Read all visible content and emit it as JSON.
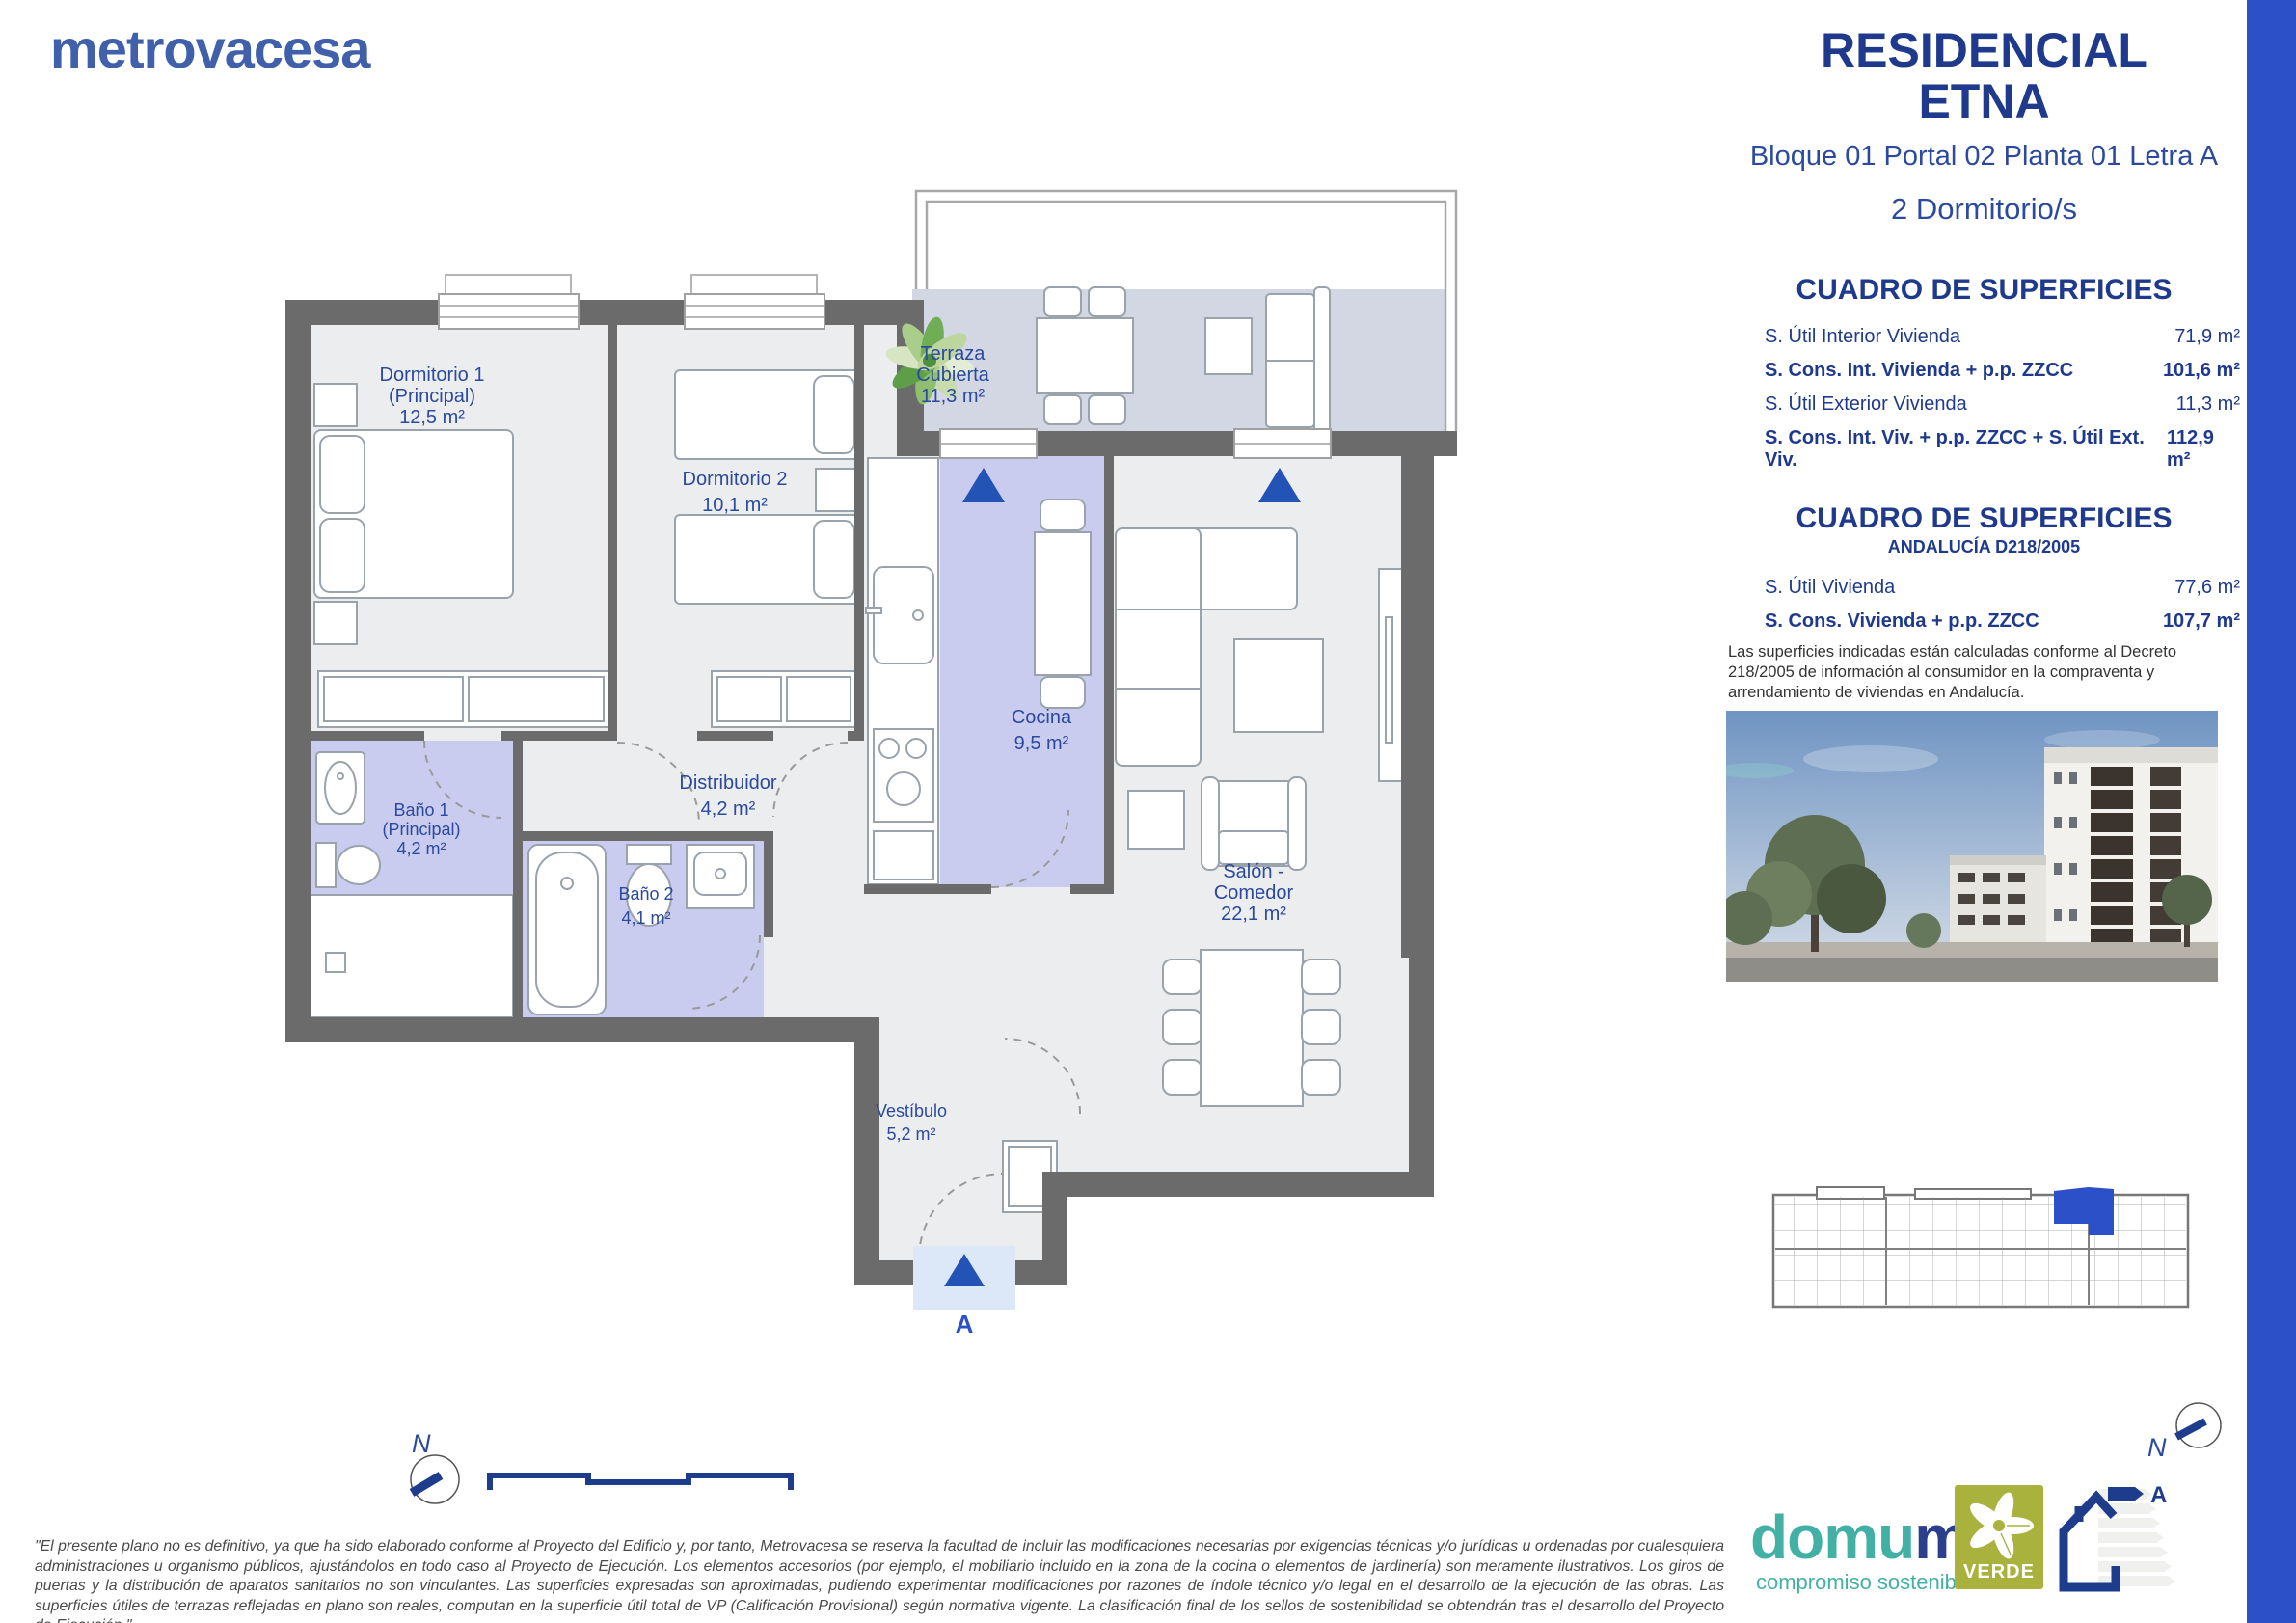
{
  "brand": {
    "logo_text": "metrovacesa"
  },
  "header": {
    "title_line1": "RESIDENCIAL",
    "title_line2": "ETNA",
    "location": "Bloque 01 Portal 02 Planta 01 Letra A",
    "bedrooms": "2 Dormitorio/s"
  },
  "surfaces": {
    "title": "CUADRO DE SUPERFICIES",
    "rows": [
      {
        "label": "S. Útil Interior Vivienda",
        "value": "71,9 m²"
      },
      {
        "label": "S. Cons. Int. Vivienda + p.p. ZZCC",
        "value": "101,6 m²"
      },
      {
        "label": "S. Útil Exterior Vivienda",
        "value": "11,3 m²"
      },
      {
        "label": "S. Cons. Int. Viv. + p.p. ZZCC + S. Útil Ext. Viv.",
        "value": "112,9 m²"
      }
    ]
  },
  "andalucia": {
    "title": "CUADRO DE SUPERFICIES",
    "subtitle": "ANDALUCÍA D218/2005",
    "rows": [
      {
        "label": "S. Útil Vivienda",
        "value": "77,6 m²"
      },
      {
        "label": "S. Cons. Vivienda + p.p. ZZCC",
        "value": "107,7 m²"
      }
    ],
    "note": "Las superficies indicadas están calculadas conforme al Decreto 218/2005 de información al consumidor en la compraventa y arrendamiento de viviendas en Andalucía."
  },
  "plan": {
    "rooms": {
      "dormitorio1": {
        "line1": "Dormitorio 1",
        "line2": "(Principal)",
        "area": "12,5 m²"
      },
      "dormitorio2": {
        "name": "Dormitorio 2",
        "area": "10,1 m²"
      },
      "terraza": {
        "line1": "Terraza",
        "line2": "Cubierta",
        "area": "11,3 m²"
      },
      "cocina": {
        "name": "Cocina",
        "area": "9,5 m²"
      },
      "salon": {
        "line1": "Salón -",
        "line2": "Comedor",
        "area": "22,1 m²"
      },
      "distribuidor": {
        "name": "Distribuidor",
        "area": "4,2 m²"
      },
      "bano1": {
        "line1": "Baño 1",
        "line2": "(Principal)",
        "area": "4,2 m²"
      },
      "bano2": {
        "name": "Baño 2",
        "area": "4,1 m²"
      },
      "vestibulo": {
        "name": "Vestíbulo",
        "area": "5,2 m²"
      }
    },
    "entrance_label": "A",
    "north_label": "N"
  },
  "footer": {
    "disclaimer": "\"El presente plano no es definitivo, ya que ha sido elaborado conforme al Proyecto del Edificio y, por tanto, Metrovacesa se reserva la facultad de incluir las modificaciones necesarias por exigencias técnicas y/o jurídicas u ordenadas por cualesquiera administraciones u organismo públicos, ajustándolos en todo caso al Proyecto de Ejecución. Los elementos accesorios (por ejemplo, el mobiliario incluido en la zona de la cocina o elementos de jardinería) son meramente ilustrativos. Los giros de puertas y la distribución de aparatos sanitarios no son vinculantes. Las superficies expresadas son aproximadas, pudiendo experimentar modificaciones por razones de índole técnico y/o legal en el desarrollo de la ejecución de las obras. Las superficies útiles de terrazas reflejadas en plano son reales, computan en la superficie útil total de VP (Calificación Provisional) según normativa vigente. La clasificación final de los sellos de sostenibilidad se obtendrán tras el desarrollo del Proyecto de Ejecución.\"",
    "domum_part1": "domu",
    "domum_part2": "m",
    "domum_tagline": "compromiso sostenible",
    "verde_label": "VERDE",
    "energy_rating": "A",
    "north_label": "N"
  },
  "colors": {
    "accent_blue": "#2b50c8",
    "navy": "#1f3a8c",
    "label_blue": "#2b4a9e",
    "logo_blue": "#4060ac",
    "wall_gray": "#6b6b6b",
    "floor_gray": "#ecedef",
    "room_lavender": "#c9ccef",
    "terrace_gray": "#d3d6e3",
    "verde_olive": "#a9b23c",
    "domum_teal": "#43b0a6"
  }
}
